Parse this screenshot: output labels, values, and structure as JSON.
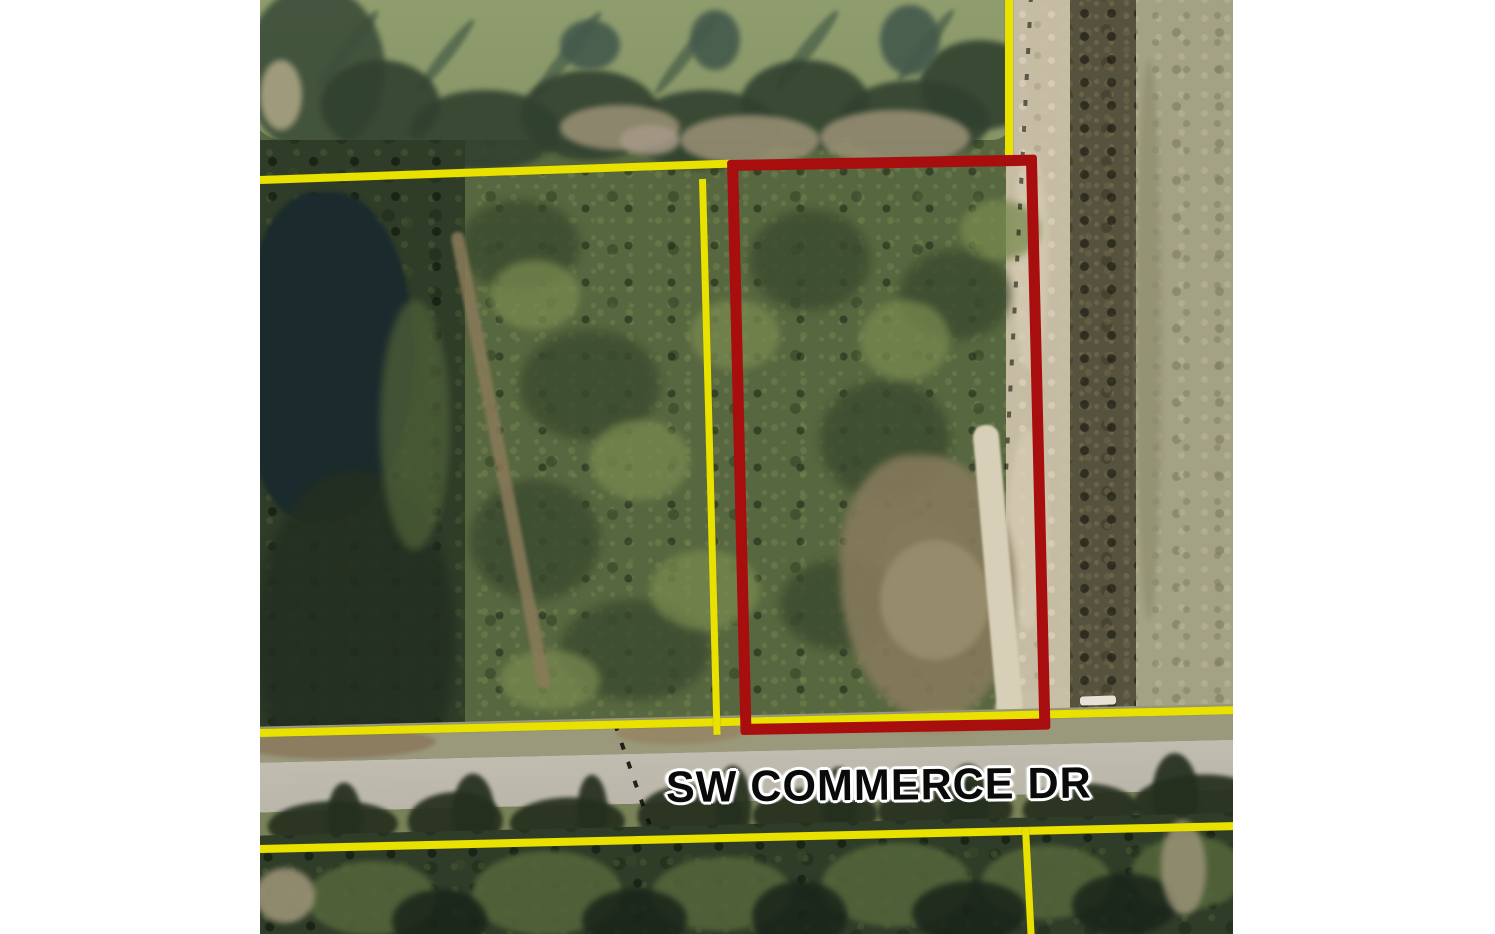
{
  "map": {
    "street_label": "SW COMMERCE DR"
  },
  "colors": {
    "letterbox": "#ffffff",
    "boundary_yellow": "#e9e200",
    "parcel_red": "#a80e0e",
    "pond_top": "#8c9a6a",
    "pond_left": "#1b2a2c",
    "forest": "#57673f",
    "forest_dark": "#2e3c28",
    "road_pavement": "#bab6a9",
    "dirt_road": "#c6bca4",
    "grass": "#a4a284",
    "street_label_text": "#0a0a0a",
    "street_label_halo": "#ffffff"
  }
}
